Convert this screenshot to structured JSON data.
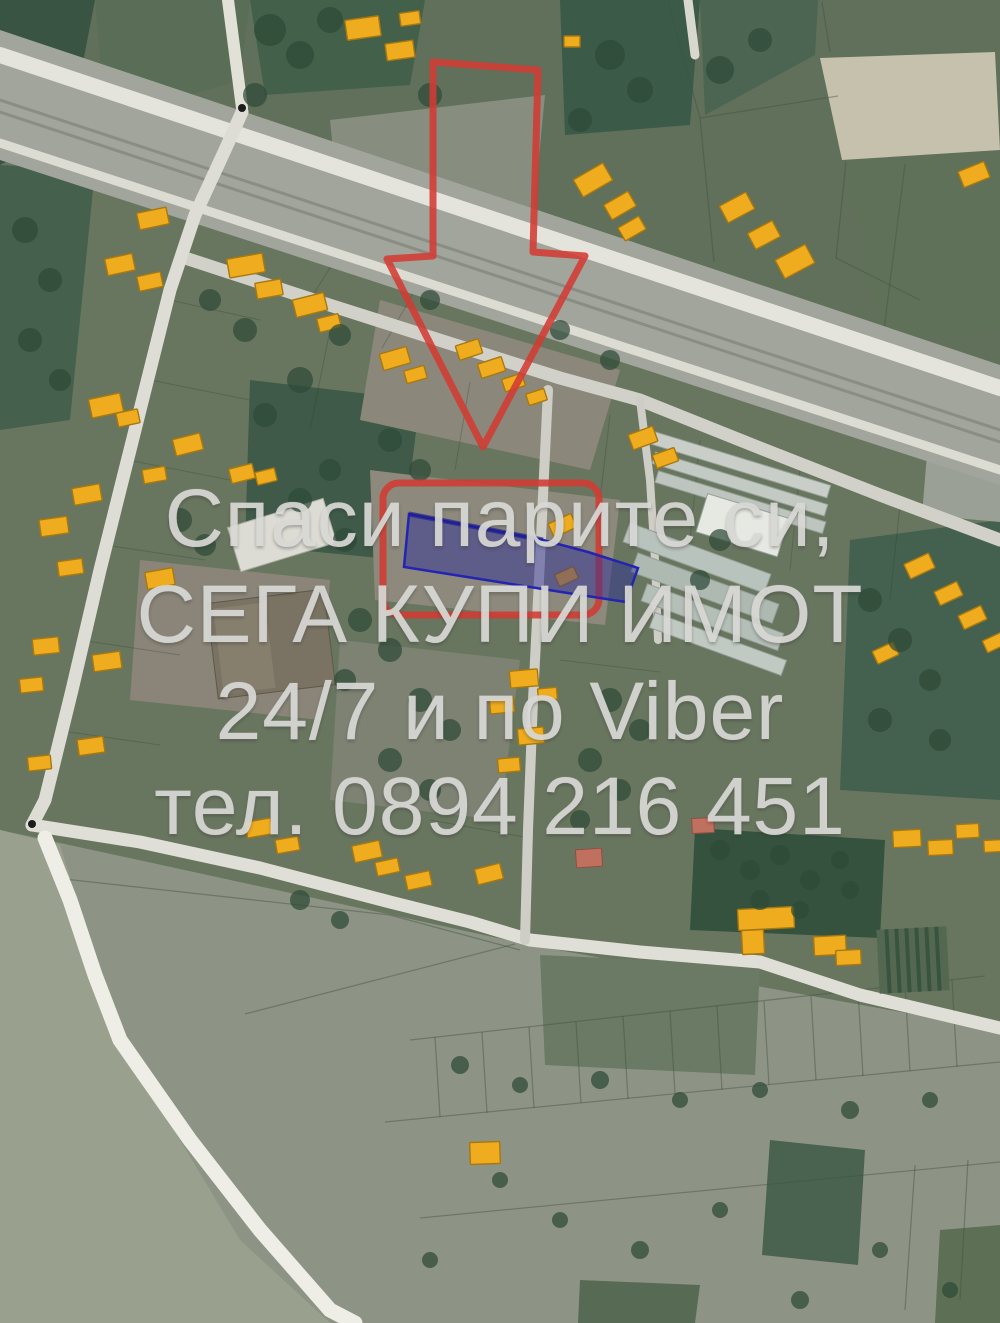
{
  "image": {
    "kind": "satellite-aerial-photo",
    "subject": "village cadastral map with advertised land plot"
  },
  "watermark": {
    "lines": [
      "Спаси парите си,",
      "СЕГА КУПИ ИМОТ",
      "24/7 и по Viber",
      "тел. 0894 216 451"
    ],
    "phone": "0894 216 451",
    "color": "#d8d8d5"
  },
  "overlay": {
    "arrow_color": "#d23b33",
    "box_color": "#d23b33",
    "parcel_fill": "#2b2b96",
    "parcel_stroke": "#2424b2"
  },
  "map": {
    "building_color": "#eeac1e",
    "building_stroke": "#a8780f",
    "red_building_color": "#c0705e",
    "buildings": [
      [
        138,
        210,
        30,
        17,
        -12
      ],
      [
        106,
        256,
        28,
        17,
        -12
      ],
      [
        138,
        274,
        24,
        15,
        -12
      ],
      [
        228,
        256,
        36,
        19,
        -10
      ],
      [
        256,
        281,
        26,
        16,
        -10
      ],
      [
        346,
        18,
        34,
        20,
        -8
      ],
      [
        386,
        42,
        28,
        17,
        -8
      ],
      [
        400,
        12,
        20,
        13,
        -8
      ],
      [
        564,
        36,
        16,
        11,
        0
      ],
      [
        576,
        170,
        34,
        20,
        -30
      ],
      [
        606,
        197,
        28,
        17,
        -30
      ],
      [
        620,
        221,
        24,
        15,
        -30
      ],
      [
        722,
        198,
        30,
        19,
        -28
      ],
      [
        750,
        226,
        28,
        18,
        -28
      ],
      [
        778,
        251,
        34,
        21,
        -28
      ],
      [
        960,
        166,
        28,
        17,
        -22
      ],
      [
        294,
        296,
        32,
        18,
        -14
      ],
      [
        318,
        316,
        22,
        14,
        -14
      ],
      [
        381,
        350,
        28,
        17,
        -16
      ],
      [
        405,
        368,
        21,
        13,
        -16
      ],
      [
        457,
        342,
        24,
        15,
        -18
      ],
      [
        479,
        360,
        25,
        15,
        -18
      ],
      [
        503,
        376,
        21,
        13,
        -18
      ],
      [
        527,
        391,
        19,
        12,
        -18
      ],
      [
        630,
        430,
        26,
        16,
        -20
      ],
      [
        654,
        451,
        23,
        14,
        -20
      ],
      [
        90,
        396,
        32,
        19,
        -12
      ],
      [
        117,
        411,
        22,
        14,
        -12
      ],
      [
        73,
        486,
        28,
        17,
        -10
      ],
      [
        143,
        468,
        23,
        14,
        -10
      ],
      [
        40,
        518,
        28,
        17,
        -8
      ],
      [
        58,
        560,
        25,
        15,
        -8
      ],
      [
        146,
        570,
        28,
        17,
        -10
      ],
      [
        33,
        638,
        26,
        16,
        -6
      ],
      [
        93,
        653,
        28,
        17,
        -8
      ],
      [
        20,
        678,
        23,
        14,
        -6
      ],
      [
        78,
        738,
        26,
        16,
        -8
      ],
      [
        28,
        756,
        23,
        14,
        -6
      ],
      [
        246,
        820,
        26,
        16,
        -10
      ],
      [
        276,
        838,
        23,
        14,
        -10
      ],
      [
        353,
        843,
        28,
        17,
        -12
      ],
      [
        376,
        860,
        23,
        14,
        -12
      ],
      [
        406,
        873,
        25,
        15,
        -12
      ],
      [
        476,
        866,
        26,
        16,
        -14
      ],
      [
        174,
        436,
        28,
        17,
        -14
      ],
      [
        230,
        466,
        24,
        15,
        -14
      ],
      [
        256,
        470,
        20,
        13,
        -14
      ],
      [
        510,
        670,
        28,
        17,
        -5
      ],
      [
        490,
        698,
        24,
        15,
        -5
      ],
      [
        518,
        728,
        26,
        16,
        -5
      ],
      [
        498,
        758,
        22,
        14,
        -5
      ],
      [
        538,
        688,
        19,
        12,
        -5
      ],
      [
        550,
        518,
        25,
        15,
        -25
      ],
      [
        556,
        570,
        21,
        13,
        -25
      ],
      [
        906,
        558,
        27,
        16,
        -25
      ],
      [
        936,
        586,
        25,
        15,
        -25
      ],
      [
        960,
        610,
        25,
        15,
        -25
      ],
      [
        984,
        636,
        21,
        13,
        -25
      ],
      [
        874,
        646,
        23,
        14,
        -25
      ],
      [
        738,
        908,
        56,
        21,
        -3
      ],
      [
        742,
        930,
        22,
        24,
        -3
      ],
      [
        814,
        936,
        32,
        19,
        -3
      ],
      [
        836,
        950,
        25,
        15,
        -3
      ],
      [
        893,
        830,
        28,
        17,
        -3
      ],
      [
        928,
        840,
        25,
        15,
        -3
      ],
      [
        956,
        824,
        23,
        14,
        -3
      ],
      [
        984,
        840,
        19,
        12,
        -3
      ],
      [
        470,
        1142,
        30,
        22,
        -2
      ]
    ],
    "red_buildings": [
      [
        576,
        849,
        26,
        18,
        -4
      ],
      [
        692,
        818,
        22,
        15,
        -3
      ]
    ],
    "trees": [
      [
        270,
        30,
        16
      ],
      [
        300,
        55,
        14
      ],
      [
        330,
        20,
        13
      ],
      [
        430,
        95,
        12
      ],
      [
        255,
        95,
        12
      ],
      [
        610,
        55,
        15
      ],
      [
        640,
        90,
        13
      ],
      [
        580,
        120,
        12
      ],
      [
        720,
        70,
        14
      ],
      [
        760,
        40,
        12
      ],
      [
        25,
        230,
        13
      ],
      [
        50,
        280,
        12
      ],
      [
        30,
        340,
        12
      ],
      [
        60,
        380,
        11
      ],
      [
        210,
        300,
        11
      ],
      [
        245,
        330,
        12
      ],
      [
        340,
        335,
        11
      ],
      [
        300,
        380,
        13
      ],
      [
        265,
        415,
        12
      ],
      [
        430,
        300,
        10
      ],
      [
        560,
        330,
        10
      ],
      [
        610,
        360,
        10
      ],
      [
        180,
        520,
        12
      ],
      [
        205,
        545,
        11
      ],
      [
        300,
        500,
        12
      ],
      [
        330,
        470,
        11
      ],
      [
        345,
        540,
        12
      ],
      [
        390,
        440,
        12
      ],
      [
        420,
        470,
        11
      ],
      [
        360,
        620,
        12
      ],
      [
        390,
        650,
        12
      ],
      [
        345,
        680,
        11
      ],
      [
        420,
        700,
        12
      ],
      [
        450,
        730,
        11
      ],
      [
        390,
        760,
        12
      ],
      [
        430,
        790,
        11
      ],
      [
        610,
        700,
        12
      ],
      [
        640,
        730,
        11
      ],
      [
        590,
        760,
        12
      ],
      [
        620,
        790,
        11
      ],
      [
        580,
        820,
        10
      ],
      [
        720,
        540,
        11
      ],
      [
        700,
        580,
        10
      ],
      [
        870,
        600,
        12
      ],
      [
        900,
        640,
        12
      ],
      [
        930,
        680,
        11
      ],
      [
        880,
        720,
        12
      ],
      [
        940,
        740,
        11
      ],
      [
        720,
        850,
        10
      ],
      [
        750,
        870,
        10
      ],
      [
        780,
        855,
        10
      ],
      [
        810,
        880,
        10
      ],
      [
        840,
        860,
        9
      ],
      [
        760,
        900,
        10
      ],
      [
        800,
        910,
        9
      ],
      [
        850,
        890,
        9
      ],
      [
        300,
        900,
        10
      ],
      [
        340,
        920,
        9
      ],
      [
        460,
        1065,
        9
      ],
      [
        520,
        1085,
        8
      ],
      [
        600,
        1080,
        9
      ],
      [
        680,
        1100,
        8
      ],
      [
        760,
        1090,
        8
      ],
      [
        850,
        1110,
        9
      ],
      [
        930,
        1100,
        8
      ],
      [
        500,
        1180,
        8
      ],
      [
        560,
        1220,
        8
      ],
      [
        640,
        1250,
        9
      ],
      [
        720,
        1210,
        8
      ],
      [
        800,
        1300,
        9
      ],
      [
        880,
        1250,
        8
      ],
      [
        950,
        1290,
        8
      ],
      [
        430,
        1260,
        8
      ]
    ],
    "lines": [
      [
        410,
        1040,
        985,
        976
      ],
      [
        385,
        1122,
        1000,
        1062
      ],
      [
        420,
        1218,
        1000,
        1162
      ],
      [
        435,
        1037,
        440,
        1117
      ],
      [
        482,
        1032,
        487,
        1113
      ],
      [
        529,
        1027,
        534,
        1108
      ],
      [
        576,
        1022,
        581,
        1103
      ],
      [
        623,
        1016,
        628,
        1099
      ],
      [
        670,
        1011,
        675,
        1094
      ],
      [
        717,
        1006,
        722,
        1090
      ],
      [
        764,
        1001,
        769,
        1085
      ],
      [
        811,
        996,
        816,
        1080
      ],
      [
        858,
        990,
        863,
        1076
      ],
      [
        905,
        985,
        910,
        1071
      ],
      [
        952,
        980,
        957,
        1067
      ],
      [
        915,
        1165,
        905,
        1310
      ],
      [
        968,
        1160,
        960,
        1300
      ],
      [
        55,
        878,
        390,
        915
      ],
      [
        390,
        915,
        520,
        950
      ],
      [
        245,
        1014,
        515,
        944
      ],
      [
        668,
        2,
        700,
        118
      ],
      [
        700,
        118,
        838,
        96
      ],
      [
        822,
        2,
        830,
        52
      ],
      [
        846,
        162,
        836,
        258
      ],
      [
        700,
        118,
        714,
        262
      ],
      [
        905,
        164,
        884,
        330
      ],
      [
        836,
        258,
        920,
        300
      ]
    ],
    "perp_lines": [
      [
        302,
        312,
        340,
        252
      ],
      [
        382,
        348,
        418,
        285
      ],
      [
        330,
        330,
        310,
        430
      ],
      [
        470,
        382,
        455,
        470
      ],
      [
        610,
        415,
        600,
        500
      ],
      [
        700,
        440,
        690,
        540
      ],
      [
        800,
        470,
        790,
        570
      ],
      [
        900,
        505,
        890,
        600
      ],
      [
        170,
        300,
        260,
        320
      ],
      [
        150,
        380,
        250,
        400
      ],
      [
        128,
        460,
        230,
        480
      ],
      [
        105,
        545,
        205,
        560
      ],
      [
        80,
        640,
        180,
        655
      ],
      [
        55,
        730,
        160,
        745
      ],
      [
        560,
        660,
        660,
        672
      ],
      [
        430,
        820,
        530,
        838
      ]
    ]
  }
}
